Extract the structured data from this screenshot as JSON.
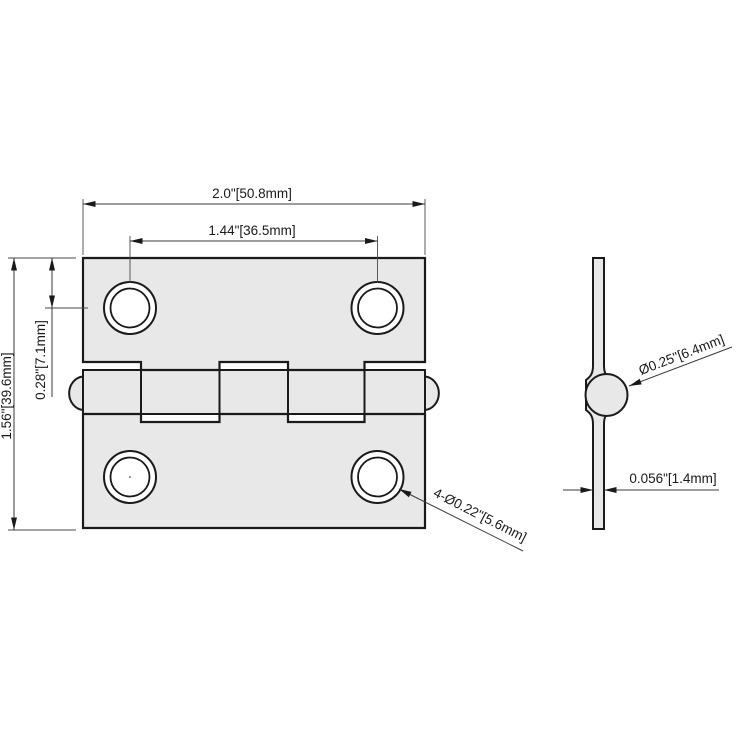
{
  "colors": {
    "background": "#ffffff",
    "part_fill": "#e8e8e8",
    "outline": "#1a1a1a",
    "dimension_line": "#3a3a3a"
  },
  "front_view": {
    "dim_overall_width": "2.0\"[50.8mm]",
    "dim_hole_spacing": "1.44\"[36.5mm]",
    "dim_overall_height": "1.56\"[39.6mm]",
    "dim_hole_offset": "0.28\"[7.1mm]",
    "dim_hole_diameter": "4-Ø0.22\"[5.6mm]"
  },
  "side_view": {
    "dim_knuckle_diameter": "Ø0.25\"[6.4mm]",
    "dim_leaf_thickness": "0.056\"[1.4mm]"
  }
}
